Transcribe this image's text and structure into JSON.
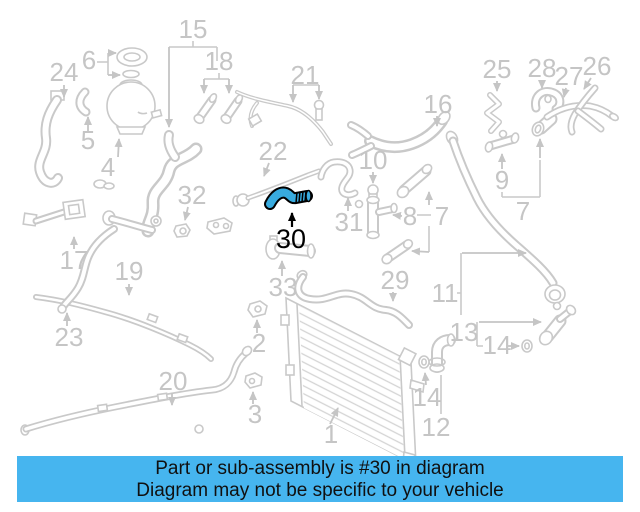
{
  "diagram": {
    "kind": "cooling-system-parts-diagram",
    "highlighted_number": "30",
    "colors": {
      "line": "#c9c9c9",
      "label": "#c5c5c5",
      "highlight_fill": "#38abdf",
      "highlight_stroke": "#000000",
      "banner_bg": "#46b5ef",
      "banner_text": "#101010",
      "background": "#ffffff"
    }
  },
  "banner": {
    "line1": "Part or sub-assembly is #30 in diagram",
    "line2": "Diagram may not be specific to your vehicle"
  },
  "parts": [
    {
      "num": "15",
      "x": 193,
      "y": 38,
      "arrows": [
        [
          169,
          47,
          169,
          127
        ]
      ]
    },
    {
      "num": "6",
      "x": 89,
      "y": 69,
      "arrows": [
        [
          108,
          53,
          116,
          53
        ],
        [
          108,
          75,
          120,
          75
        ]
      ]
    },
    {
      "num": "24",
      "x": 64,
      "y": 81,
      "arrows": [
        [
          64,
          85,
          64,
          97
        ]
      ]
    },
    {
      "num": "18",
      "x": 219,
      "y": 70,
      "arrows": [
        [
          204,
          79,
          204,
          93
        ],
        [
          229,
          79,
          229,
          93
        ]
      ]
    },
    {
      "num": "21",
      "x": 305,
      "y": 84,
      "arrows": [
        [
          293,
          85,
          293,
          102
        ],
        [
          319,
          85,
          319,
          99
        ]
      ]
    },
    {
      "num": "25",
      "x": 497,
      "y": 78,
      "arrows": [
        [
          497,
          81,
          497,
          91
        ]
      ]
    },
    {
      "num": "28",
      "x": 542,
      "y": 77,
      "arrows": [
        [
          542,
          80,
          542,
          88
        ]
      ]
    },
    {
      "num": "27",
      "x": 569,
      "y": 85,
      "arrows": [
        [
          566,
          88,
          564,
          97
        ]
      ]
    },
    {
      "num": "26",
      "x": 597,
      "y": 75,
      "arrows": [
        [
          591,
          78,
          584,
          89
        ]
      ]
    },
    {
      "num": "5",
      "x": 88,
      "y": 149,
      "arrows": [
        [
          88,
          131,
          88,
          117
        ]
      ]
    },
    {
      "num": "4",
      "x": 108,
      "y": 176,
      "arrows": [
        [
          118,
          157,
          119,
          139
        ]
      ]
    },
    {
      "num": "16",
      "x": 438,
      "y": 113,
      "arrows": [
        [
          437,
          116,
          437,
          126
        ]
      ]
    },
    {
      "num": "22",
      "x": 273,
      "y": 160,
      "arrows": [
        [
          269,
          163,
          264,
          176
        ]
      ]
    },
    {
      "num": "10",
      "x": 373,
      "y": 169,
      "arrows": [
        [
          373,
          172,
          373,
          183
        ]
      ]
    },
    {
      "num": "32",
      "x": 192,
      "y": 204,
      "arrows": [
        [
          188,
          207,
          185,
          220
        ]
      ]
    },
    {
      "num": "31",
      "x": 349,
      "y": 231,
      "arrows": [
        [
          348,
          211,
          348,
          198
        ]
      ]
    },
    {
      "num": "9",
      "x": 502,
      "y": 189,
      "arrows": [
        [
          502,
          169,
          502,
          154
        ]
      ]
    },
    {
      "num": "8",
      "x": 410,
      "y": 225,
      "arrows": [
        [
          402,
          216,
          393,
          215
        ]
      ]
    },
    {
      "num": "7",
      "x": 442,
      "y": 225,
      "arrows": [
        [
          429,
          205,
          429,
          192
        ],
        [
          429,
          252,
          412,
          251
        ]
      ]
    },
    {
      "num": "7",
      "x": 523,
      "y": 220,
      "arrows": [
        [
          540,
          158,
          540,
          139
        ]
      ]
    },
    {
      "num": "17",
      "x": 74,
      "y": 269,
      "arrows": [
        [
          74,
          249,
          74,
          237
        ]
      ]
    },
    {
      "num": "19",
      "x": 129,
      "y": 280,
      "arrows": [
        [
          129,
          284,
          129,
          295
        ]
      ]
    },
    {
      "num": "23",
      "x": 69,
      "y": 346,
      "arrows": [
        [
          67,
          326,
          67,
          313
        ]
      ]
    },
    {
      "num": "33",
      "x": 283,
      "y": 296,
      "arrows": [
        [
          282,
          276,
          282,
          261
        ]
      ]
    },
    {
      "num": "29",
      "x": 395,
      "y": 289,
      "arrows": [
        [
          393,
          292,
          393,
          301
        ]
      ]
    },
    {
      "num": "11",
      "x": 445,
      "y": 302,
      "arrows": [
        [
          462,
          253,
          526,
          253
        ]
      ]
    },
    {
      "num": "2",
      "x": 259,
      "y": 352,
      "arrows": [
        [
          257,
          333,
          257,
          320
        ]
      ]
    },
    {
      "num": "3",
      "x": 255,
      "y": 423,
      "arrows": [
        [
          253,
          404,
          253,
          392
        ]
      ]
    },
    {
      "num": "13",
      "x": 464,
      "y": 341,
      "arrows": [
        [
          479,
          322,
          541,
          322
        ]
      ]
    },
    {
      "num": "14",
      "x": 497,
      "y": 354,
      "arrows": [
        [
          508,
          346,
          519,
          346
        ]
      ]
    },
    {
      "num": "14",
      "x": 427,
      "y": 406,
      "arrows": [
        [
          426,
          385,
          425,
          373
        ]
      ]
    },
    {
      "num": "12",
      "x": 436,
      "y": 436,
      "arrows": []
    },
    {
      "num": "20",
      "x": 173,
      "y": 390,
      "arrows": [
        [
          172,
          393,
          172,
          405
        ]
      ]
    },
    {
      "num": "1",
      "x": 331,
      "y": 443,
      "arrows": [
        [
          330,
          424,
          338,
          408
        ]
      ]
    },
    {
      "num": "30",
      "x": 291,
      "y": 248,
      "highlighted": true,
      "arrows": [
        [
          292,
          227,
          292,
          213
        ]
      ]
    }
  ]
}
